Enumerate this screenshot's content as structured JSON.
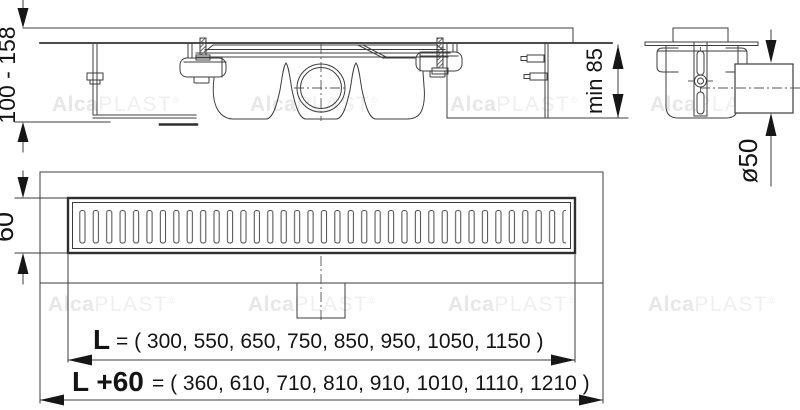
{
  "dimensions": {
    "installation_height": "100 - 158",
    "min_installation_depth": "min 85",
    "outlet_pipe_diameter": "ø50",
    "grate_width": "60",
    "length": {
      "label": "L",
      "values_text": "= ( 300, 550, 650, 750, 850, 950, 1050, 1150 )",
      "values": [
        300,
        550,
        650,
        750,
        850,
        950,
        1050,
        1150
      ]
    },
    "length_plus_60": {
      "label": "L +60",
      "values_text": "= ( 360, 610, 710, 810, 910, 1010, 1110, 1210 )",
      "values": [
        360,
        610,
        710,
        810,
        910,
        1010,
        1110,
        1210
      ]
    }
  },
  "watermark": {
    "brand_bold": "Alca",
    "brand_light": "PLAST",
    "registered": "®"
  },
  "colors": {
    "line": "#3c3c3c",
    "text": "#141414",
    "watermark": "#e7e7e7",
    "background": "#ffffff"
  }
}
